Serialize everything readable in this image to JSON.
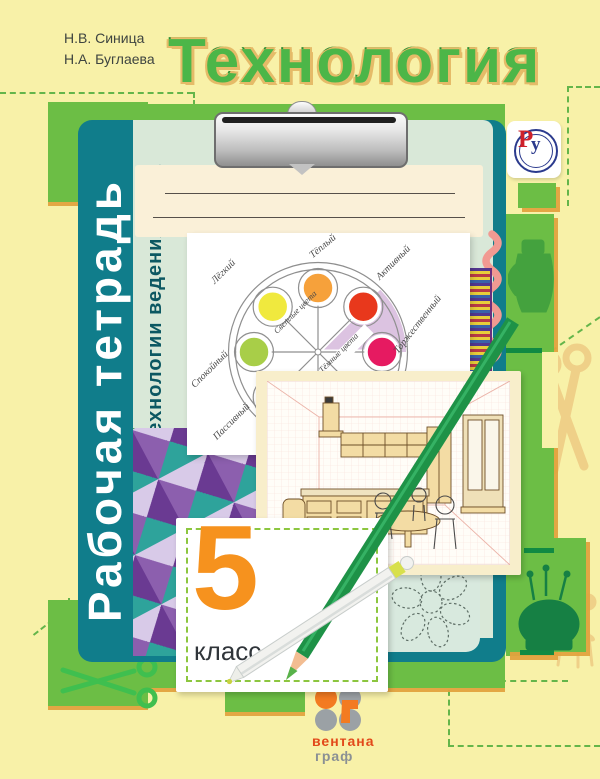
{
  "cover": {
    "authors": [
      "Н.В. Синица",
      "Н.А. Буглаева"
    ],
    "title": "Технология",
    "series": "Рабочая тетрадь",
    "subtitle": "Технологии ведения дома",
    "grade": {
      "number": "5",
      "word": "класс"
    },
    "publisher": {
      "name_top": "вентана",
      "name_bottom": "граф"
    },
    "ru_logo": {
      "letter_p": "Р",
      "letter_u": "у"
    }
  },
  "color_wheel": {
    "labels": [
      {
        "text": "Тёплый",
        "color": "#F6A13B",
        "position": "top"
      },
      {
        "text": "Активный",
        "color": "#E8381C",
        "position": "upper-right"
      },
      {
        "text": "Торжественный",
        "color": "#E61A61",
        "position": "right"
      },
      {
        "text": "Лёгкий",
        "color": "#F0E93E",
        "position": "upper-left"
      },
      {
        "text": "Спокойный",
        "color": "#A8CE48",
        "position": "left"
      },
      {
        "text": "Пассивный",
        "color": "#5FB94A",
        "position": "lower-left"
      }
    ],
    "spoke_labels": [
      "Светлые цвета",
      "Тёмные цвета"
    ]
  },
  "decorations": {
    "icons": [
      "clip-icon",
      "scissors-icon",
      "jug-icon",
      "pincushion-icon",
      "flower-icon",
      "pencil-icon",
      "pen-icon",
      "rickrack-ribbon-icon",
      "braid-ribbon-icon",
      "quilt-pattern",
      "dotted-flower-icon"
    ]
  },
  "colors": {
    "background": "#F8F1A8",
    "title_green": "#4CB648",
    "title_outline": "#E5BB68",
    "panel_green": "#6CBE45",
    "clipboard_teal": "#107D8B",
    "clipboard_mint": "#D9E8D8",
    "grade_orange": "#F6921E",
    "publisher_orange": "#E2491A",
    "publisher_gray": "#8A9094",
    "wheel_sector_purple": "#DCC3E1"
  }
}
